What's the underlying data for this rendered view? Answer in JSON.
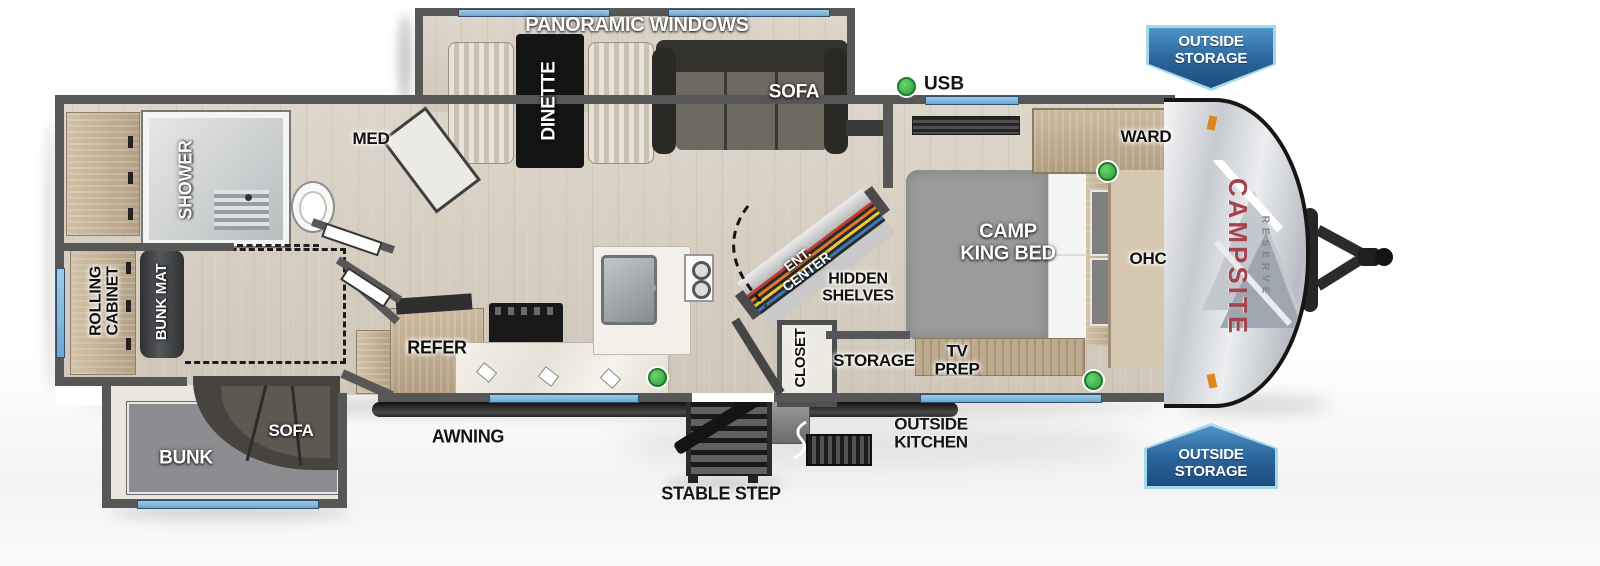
{
  "colors": {
    "wall": "#575757",
    "floor_wood": "#d8d1c5",
    "window_blue": "#7db9dd",
    "banner_blue": "#2a6399",
    "banner_border": "#a6d8ec",
    "usb_green": "#2e9e3b",
    "brand_red": "#a4424d",
    "accent_orange": "#e0871c"
  },
  "legend": {
    "usb": "USB"
  },
  "exterior": {
    "awning": "AWNING",
    "stable_step": "STABLE STEP",
    "outside_kitchen": "OUTSIDE\nKITCHEN",
    "outside_storage_top": "OUTSIDE\nSTORAGE",
    "outside_storage_bottom": "OUTSIDE\nSTORAGE",
    "brand": "CAMPSITE",
    "brand_sub": "RESERVE"
  },
  "slide_top": {
    "banner": "PANORAMIC WINDOWS",
    "dinette": "DINETTE",
    "sofa": "SOFA"
  },
  "bathroom": {
    "shower": "SHOWER",
    "med": "MED"
  },
  "bunk_room": {
    "rolling_cabinet": "ROLLING\nCABINET",
    "bunk_mat": "BUNK MAT"
  },
  "kitchen": {
    "refer": "REFER"
  },
  "living": {
    "ent_center": "ENT.\nCENTER",
    "hidden_shelves": "HIDDEN\nSHELVES",
    "closet": "CLOSET",
    "storage": "STORAGE"
  },
  "bedroom": {
    "bed": "CAMP\nKING BED",
    "ward": "WARD",
    "ohc": "OHC",
    "tv_prep": "TV\nPREP"
  },
  "slide_bottom": {
    "bunk": "BUNK",
    "sofa": "SOFA"
  }
}
